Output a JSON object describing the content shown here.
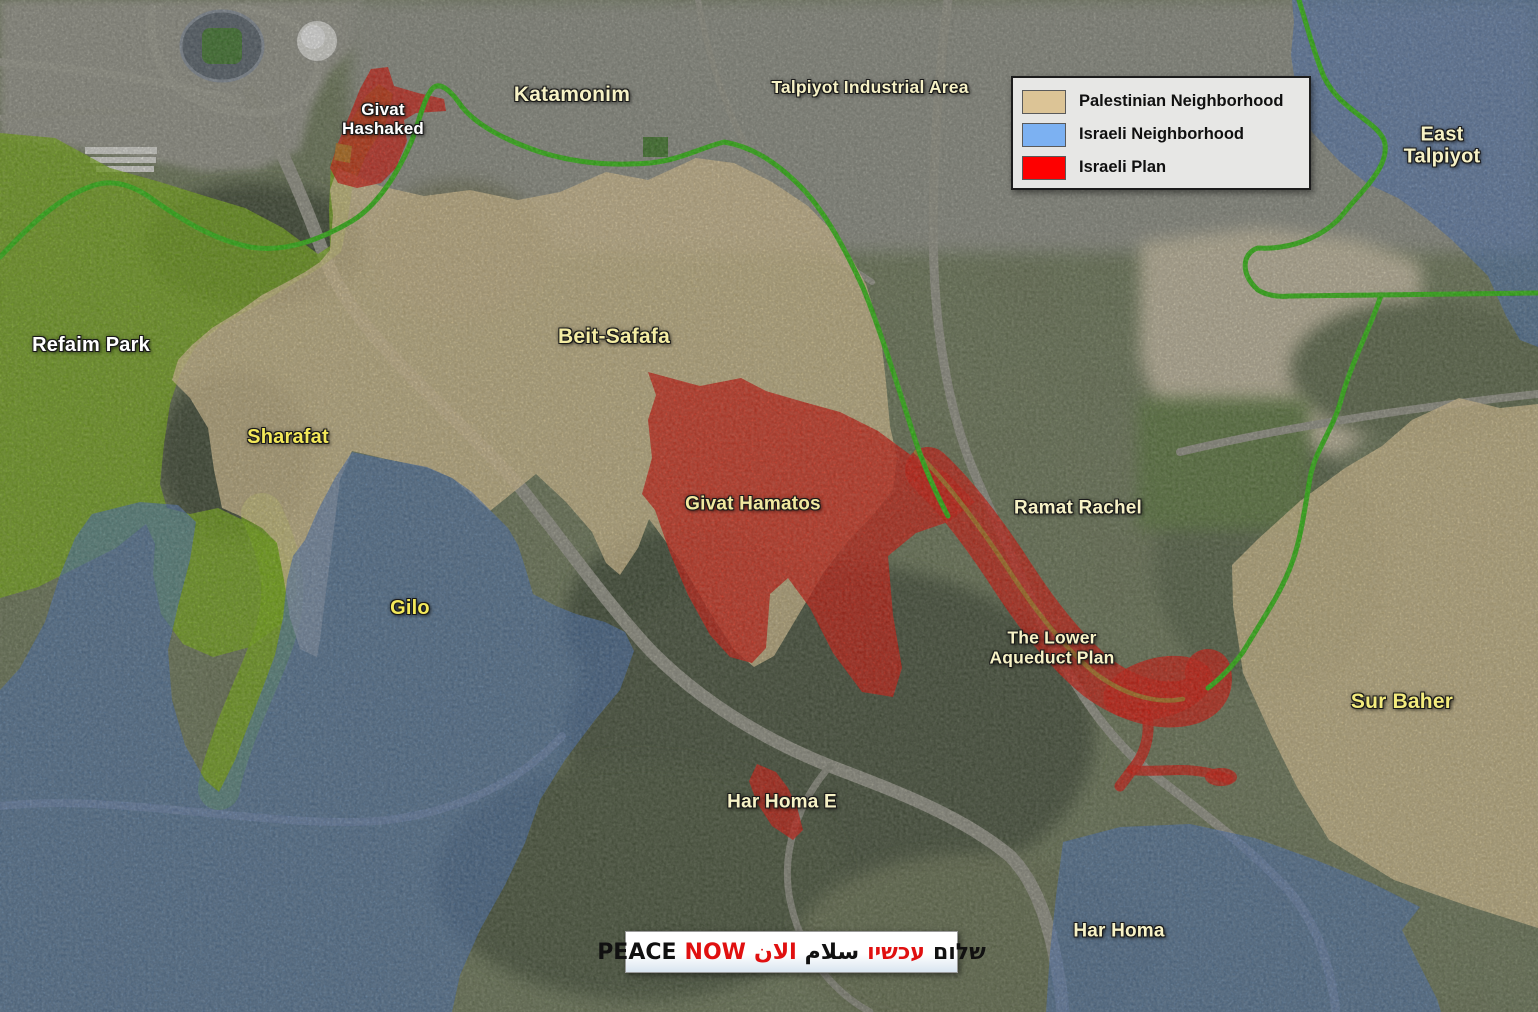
{
  "legend": {
    "items": [
      {
        "label": "Palestinian Neighborhood",
        "color": "#DCC496"
      },
      {
        "label": "Israeli Neighborhood",
        "color": "#7CB1F2"
      },
      {
        "label": "Israeli Plan",
        "color": "#FE0000"
      }
    ]
  },
  "labels": [
    {
      "id": "refaim-park",
      "text": "Refaim Park"
    },
    {
      "id": "givat-hashaked",
      "text": "Givat\nHashaked"
    },
    {
      "id": "katamonim",
      "text": "Katamonim"
    },
    {
      "id": "talpiyot-industrial",
      "text": "Talpiyot Industrial Area"
    },
    {
      "id": "east-talpiyot",
      "text": "East Talpiyot"
    },
    {
      "id": "sharafat",
      "text": "Sharafat"
    },
    {
      "id": "beit-safafa",
      "text": "Beit-Safafa"
    },
    {
      "id": "gilo",
      "text": "Gilo"
    },
    {
      "id": "givat-hamatos",
      "text": "Givat Hamatos"
    },
    {
      "id": "ramat-rachel",
      "text": "Ramat Rachel"
    },
    {
      "id": "lower-aqueduct",
      "text": "The Lower\nAqueduct Plan"
    },
    {
      "id": "sur-baher",
      "text": "Sur Baher"
    },
    {
      "id": "har-homa-e",
      "text": "Har Homa E"
    },
    {
      "id": "har-homa",
      "text": "Har Homa"
    }
  ],
  "banner": {
    "words": [
      {
        "text": "PEACE",
        "color": "black"
      },
      {
        "text": "NOW",
        "color": "red"
      },
      {
        "text": "الان",
        "color": "red"
      },
      {
        "text": "سلام",
        "color": "black"
      },
      {
        "text": "עכשיו",
        "color": "red"
      },
      {
        "text": "שלום",
        "color": "black"
      }
    ]
  },
  "map_colors": {
    "palestinian_overlay": "#E8D098",
    "israeli_overlay": "#4A79C8",
    "israeli_plan_overlay": "#E11507",
    "park_overlay": "#7DB80E",
    "green_line": "#2FC50B",
    "aqueduct_line": "#B5791F"
  }
}
